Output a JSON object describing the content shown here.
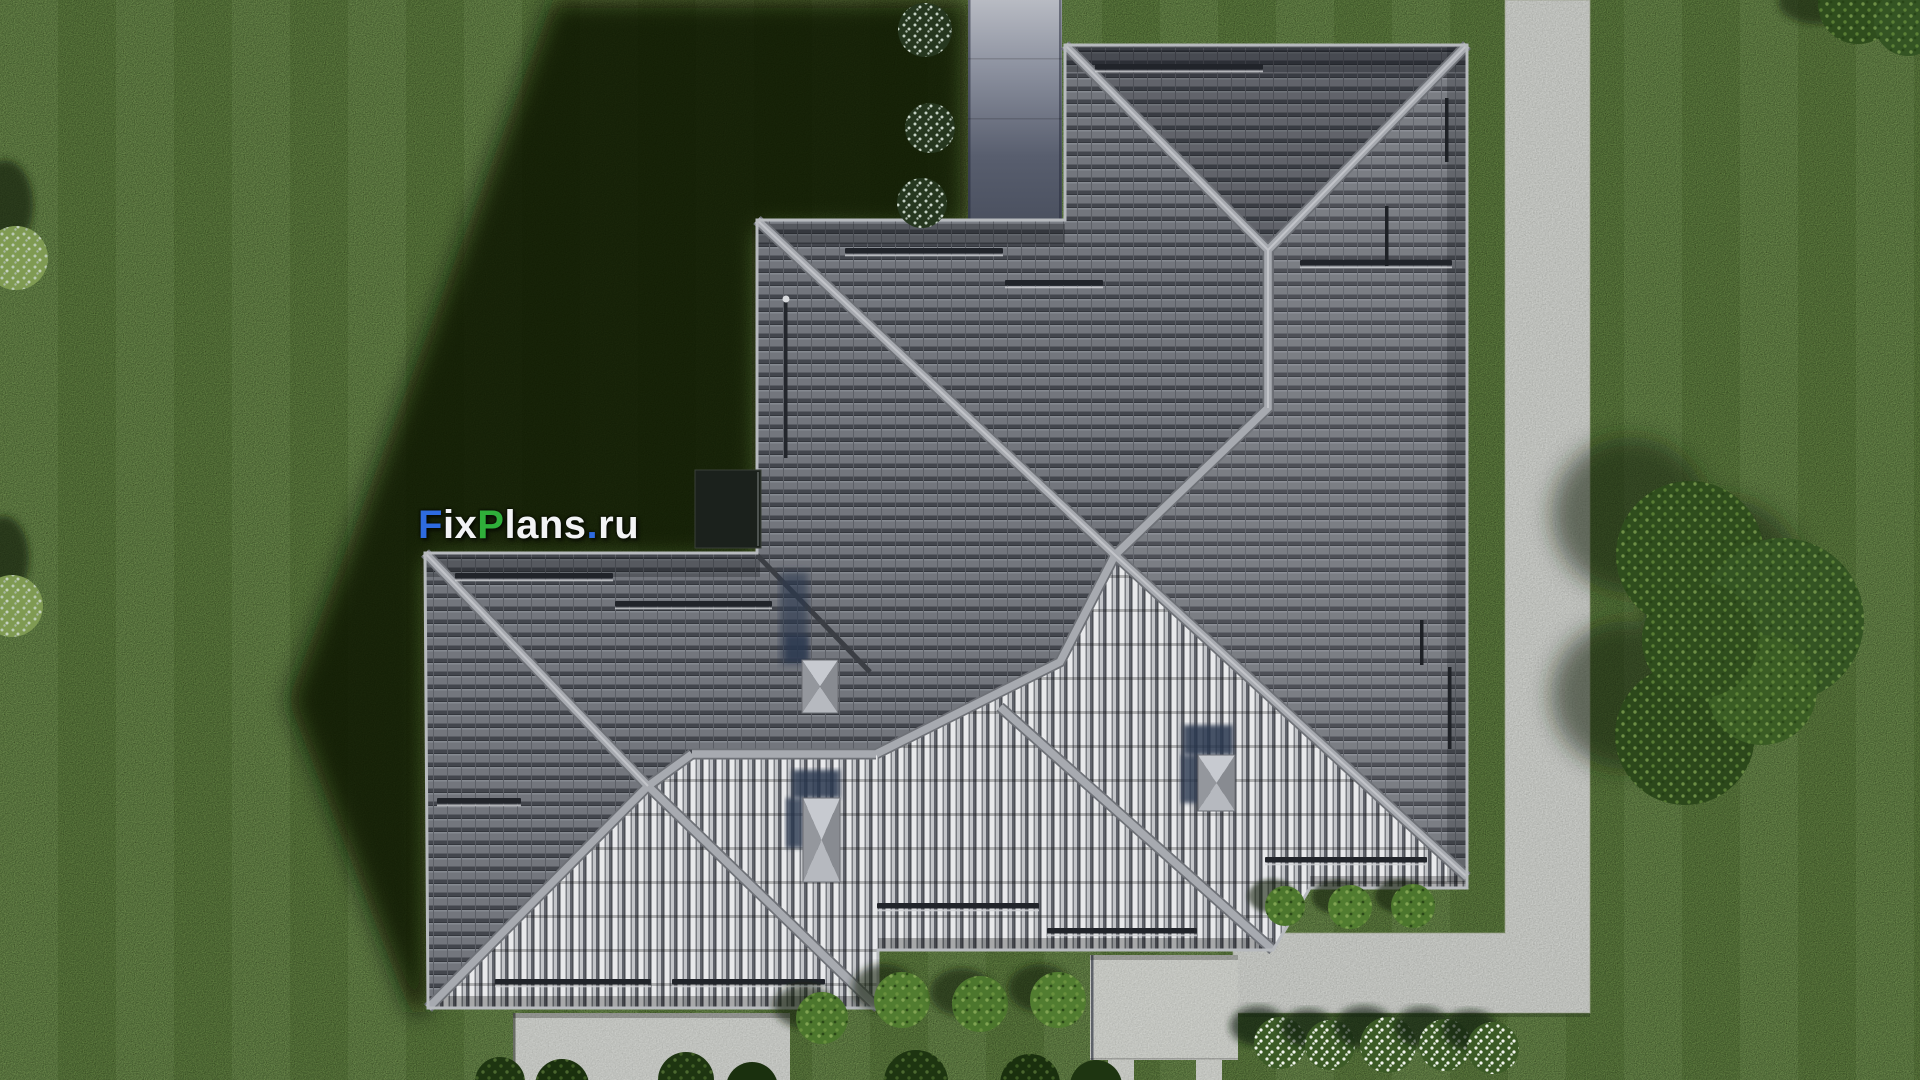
{
  "watermark": {
    "text": "FixPlans.ru",
    "segments": [
      {
        "text": "F",
        "color": "#2e6be0"
      },
      {
        "text": "ix",
        "color": "#f2f3f5"
      },
      {
        "text": "P",
        "color": "#2fae3a"
      },
      {
        "text": "lans",
        "color": "#f2f3f5"
      },
      {
        "text": ".",
        "color": "#2e6be0"
      },
      {
        "text": "ru",
        "color": "#f2f3f5"
      }
    ]
  },
  "palette": {
    "grass": "#5e7c3f",
    "shadow": "#0c1706",
    "roofBase": "#73767d",
    "roofDark": "#43464d",
    "ridge": "#a7aab0",
    "ridgeEdge": "#6e7177",
    "eave": "#b7babe",
    "stripe": "#e8e9eb",
    "concrete": "#c8cac6",
    "patio": "#cccec9",
    "pad": "#c9cbc7",
    "entryTop": "#b8bbc3",
    "entryBottom": "#4a505f",
    "chimney": "#b3b6bb",
    "navy": "#2b374f",
    "vent": "#21242a",
    "bush": "#4c762d",
    "tree": "#2f4d1d",
    "flower": "#eef3ea"
  },
  "scene": {
    "view": "top-down aerial render",
    "subject": "house hip roof with gray tiles",
    "roof": {
      "chimneys": 3,
      "skylights": 1,
      "snow_guard_strips": 12
    },
    "ground": [
      "lawn",
      "perimeter concrete path",
      "entry walkway",
      "patio",
      "driveway pad"
    ],
    "vegetation": {
      "flower_bushes_bottom_row": 5,
      "flower_bushes_top_shaded": 3,
      "hedge_bushes_bottom": 4,
      "hedge_bushes_side": 3,
      "left_edge_bushes": 2,
      "tree_cluster_right": true
    }
  }
}
